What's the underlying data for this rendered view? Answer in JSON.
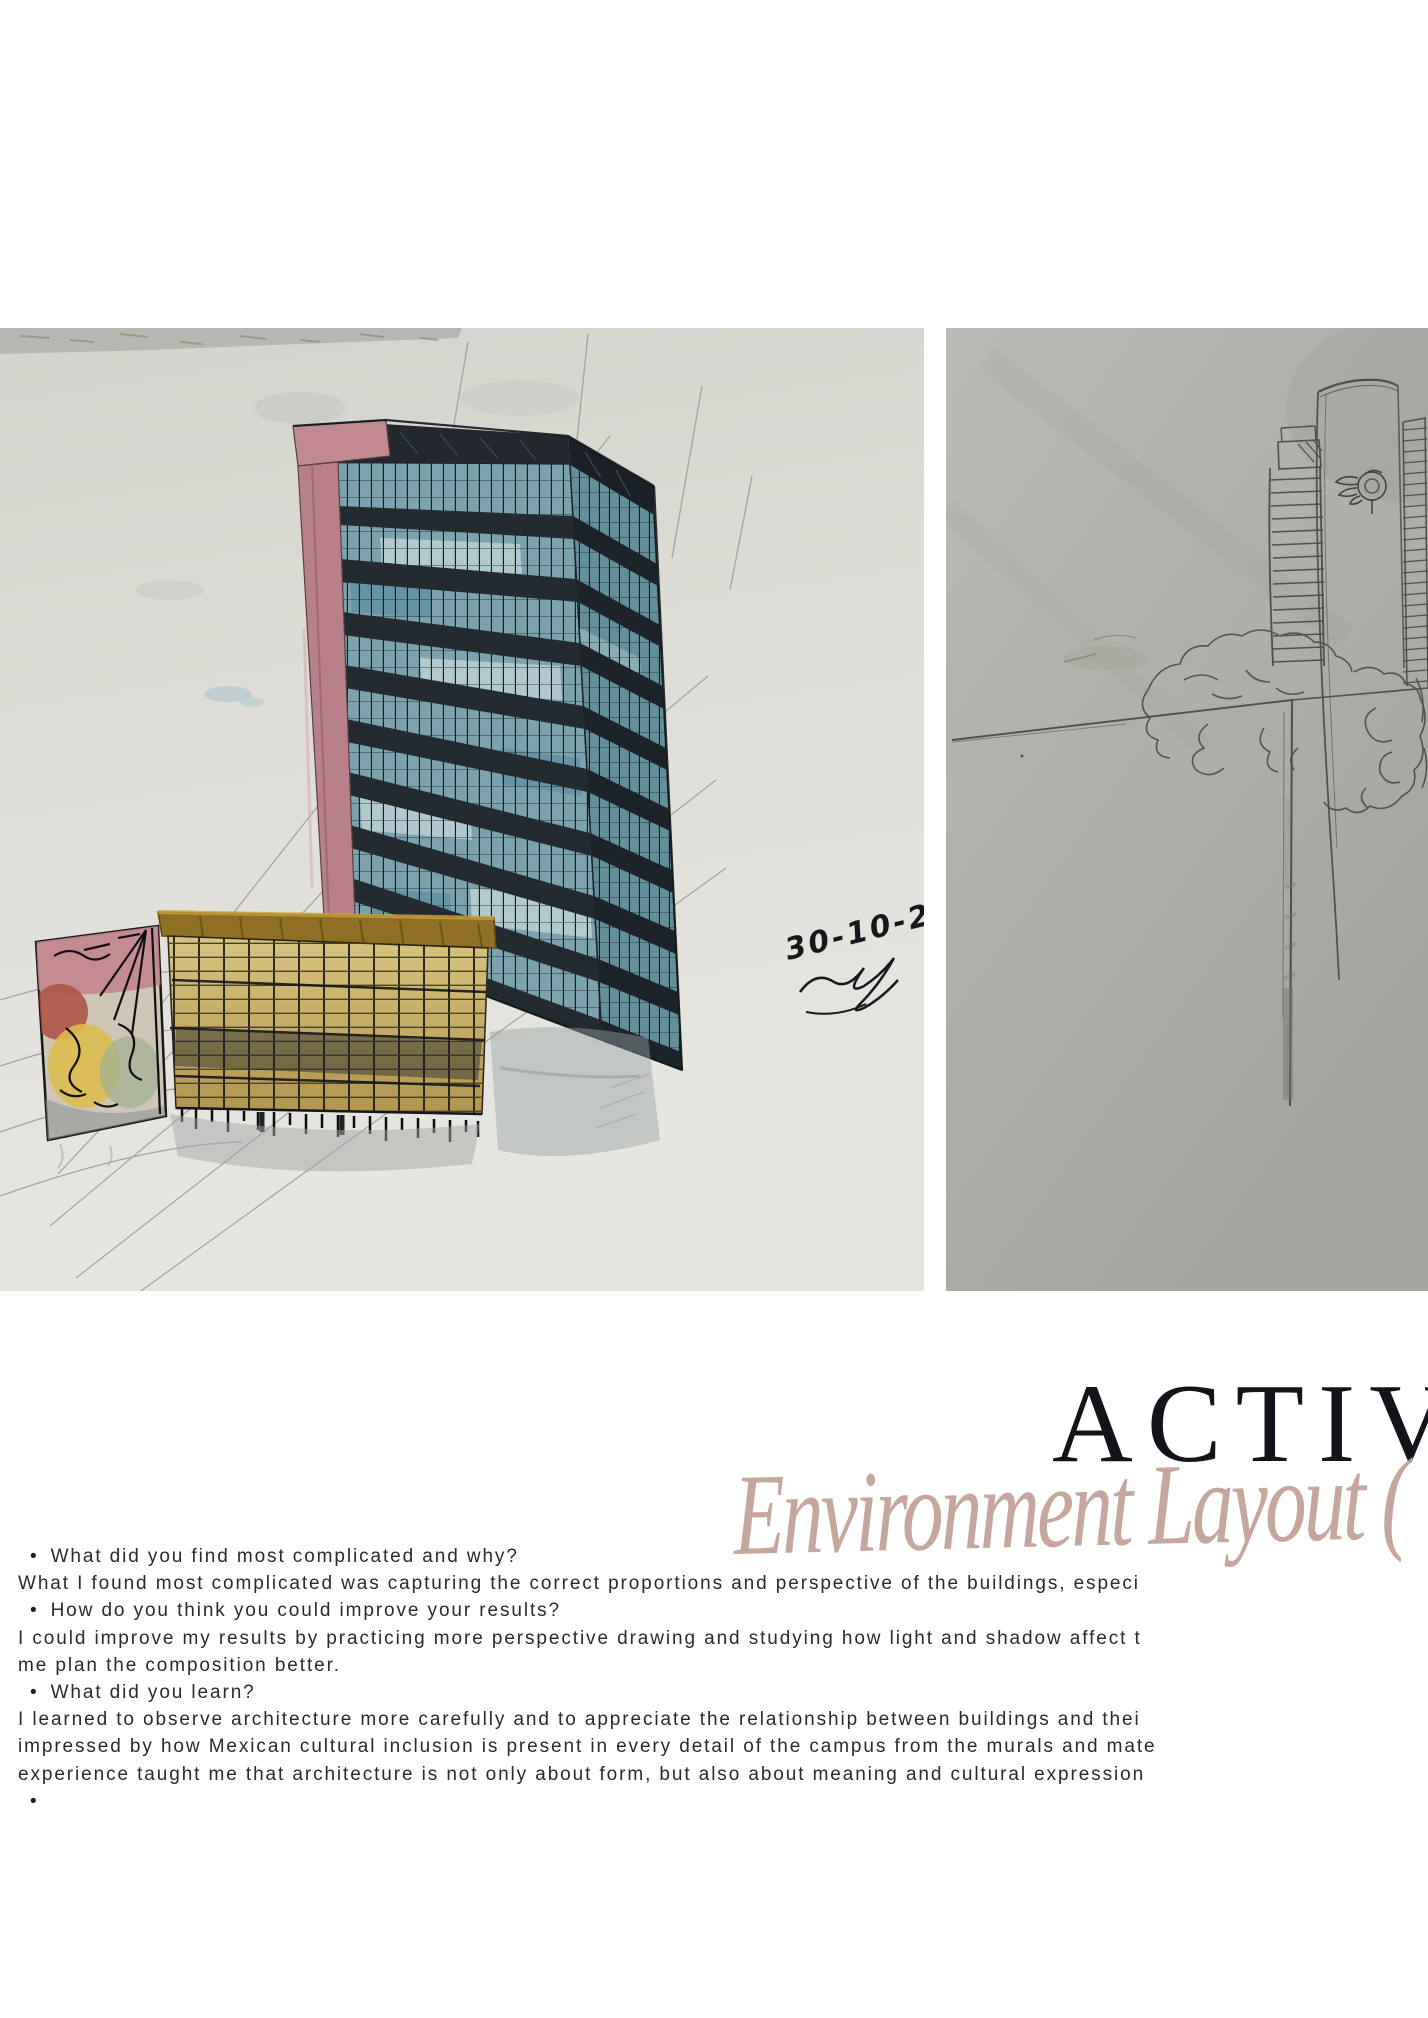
{
  "header": {
    "title": "ACTIV",
    "subtitle_script": "Environment Layout (",
    "title_color": "#131319",
    "script_color": "#c2a399"
  },
  "photos": {
    "left": {
      "description": "watercolor and ink sketch of a teal glass tower with pink side wall and a low yellow slab building with mural",
      "date_inscription": "30-10-25",
      "paper_color": "#dedcd6"
    },
    "right": {
      "description": "pencil sketch on gray paper of campus towers, low building edge and trees",
      "paper_color": "#adaca6"
    }
  },
  "qa": {
    "bullet_char": "•",
    "lines": [
      {
        "type": "bullet",
        "text": "What did you find most complicated and why?"
      },
      {
        "type": "body",
        "text": "What I found most complicated was capturing the correct proportions and perspective of the buildings, especi"
      },
      {
        "type": "bullet",
        "text": "How do you think you could improve your results?"
      },
      {
        "type": "body",
        "text": "I could improve my results by practicing more perspective drawing and studying how light and shadow affect t"
      },
      {
        "type": "body",
        "text": "me plan the composition better."
      },
      {
        "type": "bullet",
        "text": "What did you learn?"
      },
      {
        "type": "body",
        "text": "I learned to observe architecture more carefully and to appreciate the relationship between buildings and thei"
      },
      {
        "type": "body",
        "text": "impressed by how Mexican cultural inclusion is present in every detail of the campus from the murals and mate"
      },
      {
        "type": "body",
        "text": "experience taught me that architecture is not only about form, but also about meaning and cultural expression"
      },
      {
        "type": "bullet",
        "text": ""
      }
    ]
  }
}
